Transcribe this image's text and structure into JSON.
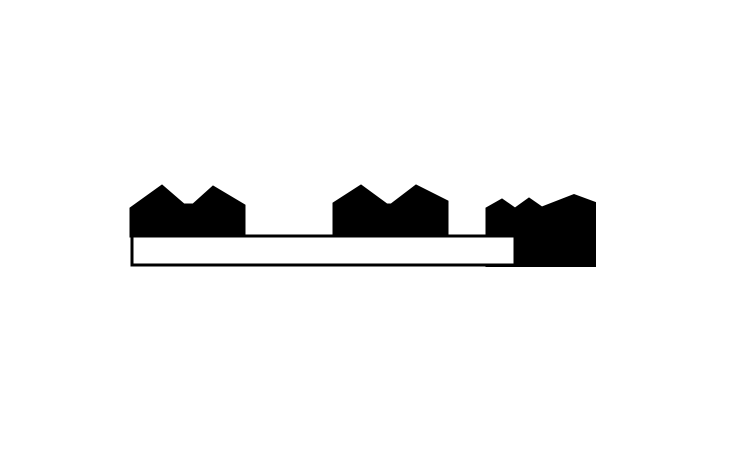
{
  "canvas": {
    "width": 736,
    "height": 460,
    "background": "#ffffff"
  },
  "graphic": {
    "description": "Black silhouette of three gabled building clusters resting on a long white horizontal bar outlined in black; the rightmost cluster extends down over the right end of the bar",
    "ink_color": "#000000",
    "paper_color": "#ffffff",
    "buildings": [
      {
        "name": "building-silhouette-left",
        "points": [
          [
            130,
            237
          ],
          [
            130,
            208
          ],
          [
            162,
            185
          ],
          [
            184,
            204
          ],
          [
            193,
            204
          ],
          [
            213,
            186
          ],
          [
            245,
            205
          ],
          [
            245,
            237
          ]
        ]
      },
      {
        "name": "building-silhouette-middle",
        "points": [
          [
            333,
            237
          ],
          [
            333,
            203
          ],
          [
            361,
            185
          ],
          [
            387,
            204
          ],
          [
            391,
            204
          ],
          [
            416,
            185
          ],
          [
            448,
            201
          ],
          [
            448,
            237
          ]
        ]
      },
      {
        "name": "building-silhouette-right",
        "points": [
          [
            486,
            266.5
          ],
          [
            486,
            208
          ],
          [
            502,
            199
          ],
          [
            515,
            208
          ],
          [
            529,
            198
          ],
          [
            542,
            207
          ],
          [
            574,
            194.5
          ],
          [
            595.5,
            202.5
          ],
          [
            595.5,
            266.5
          ]
        ]
      }
    ],
    "bar": {
      "x": 132,
      "y": 236,
      "width": 383,
      "height": 29,
      "stroke_width": 3,
      "fill": "#ffffff",
      "stroke": "#000000"
    }
  }
}
